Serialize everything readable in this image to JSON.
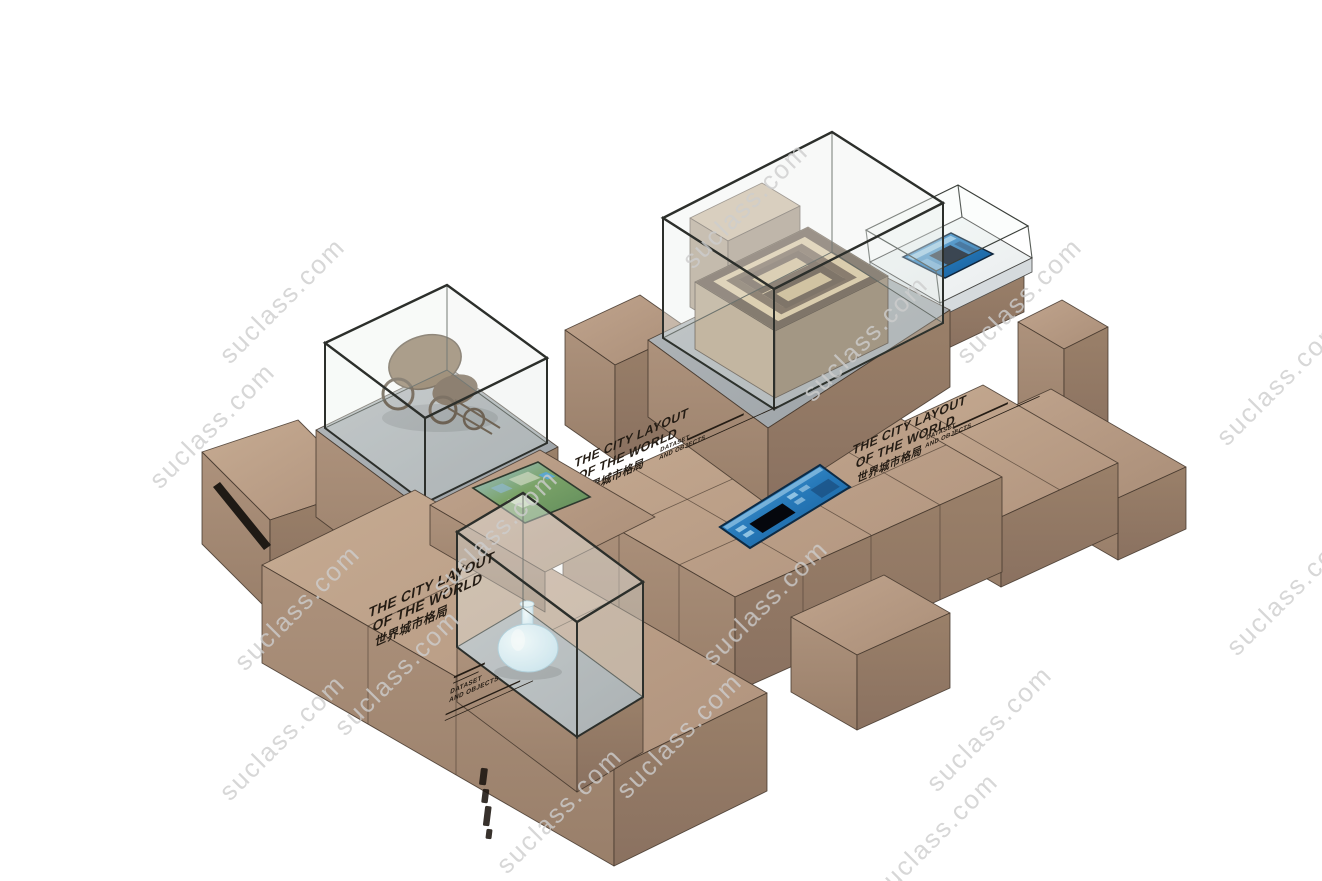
{
  "scene": {
    "description_visible": false,
    "background": "#ffffff"
  },
  "watermark": {
    "text": "suclass.com",
    "color": "#cdcdcd"
  },
  "labels": {
    "title": {
      "line1": "THE CITY LAYOUT",
      "line2": "OF THE WORLD",
      "line3_zh": "世界城市格局"
    },
    "caption": {
      "line1": "DATASET",
      "line2": "AND OBJECTS"
    }
  },
  "colors": {
    "wood_top": "#bca08a",
    "wood_side_light": "#a78c76",
    "wood_side_dark": "#927a66",
    "glass_tint": "#dfeae6",
    "glass_frame": "#2c2f2b",
    "case_floor_gray": "#a9aeb1",
    "screen_blue": "#2e7fc2",
    "screen_navy": "#0a1526",
    "white_table": "#f4f6f6",
    "engraved_text": "#241c14",
    "model_tan": "#d8c49d",
    "model_brown": "#6d5a49"
  }
}
